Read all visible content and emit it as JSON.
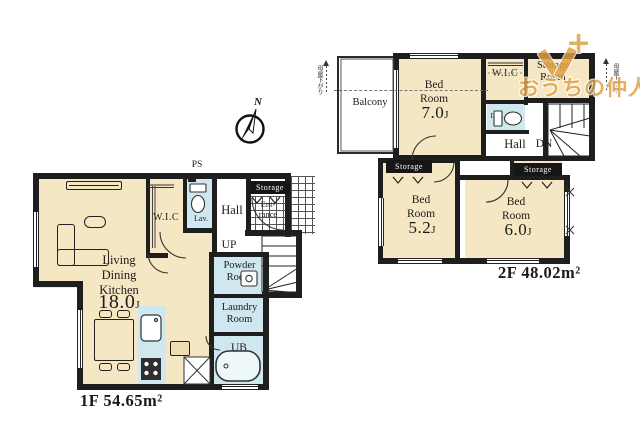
{
  "watermark": {
    "plus": "+",
    "brand": "おうちの仲人",
    "color": "#dfa044"
  },
  "annotations": {
    "compass": "N",
    "slope_note_left": "母屋下がり",
    "slope_note_right": "母屋下がり"
  },
  "colors": {
    "wall": "#1e1e1e",
    "floor_cream": "#f5e6c4",
    "wet_blue": "#cfe7ef",
    "white": "#ffffff",
    "watermark_orange": "#dfa044"
  },
  "floors": {
    "f1": {
      "area_label": "1F 54.65m²",
      "rooms": {
        "ldk": {
          "lines": [
            "Living",
            "Dining",
            "Kitchen"
          ],
          "size": "18.0",
          "size_unit": "J"
        },
        "wic": "W.I.C",
        "lav": "Lav.",
        "hall": "Hall",
        "storage": "Storage",
        "entrance": {
          "lines": [
            "Ent-",
            "rance"
          ]
        },
        "up": "UP",
        "ps": "PS",
        "powder": {
          "lines": [
            "Powder",
            "Room"
          ]
        },
        "laundry": {
          "lines": [
            "Laundry",
            "Room"
          ]
        },
        "ub": "UB"
      }
    },
    "f2": {
      "area_label": "2F 48.02m²",
      "rooms": {
        "balcony": "Balcony",
        "bed7": {
          "lines": [
            "Bed",
            "Room"
          ],
          "size": "7.0",
          "size_unit": "J"
        },
        "bed5": {
          "lines": [
            "Bed",
            "Room"
          ],
          "size": "5.2",
          "size_unit": "J"
        },
        "bed6": {
          "lines": [
            "Bed",
            "Room"
          ],
          "size": "6.0",
          "size_unit": "J"
        },
        "wic": "W.I.C",
        "storage_room": {
          "lines": [
            "Storage",
            "Room"
          ]
        },
        "lav": "Lav.",
        "hall": "Hall",
        "dn": "DN",
        "storage_left": "Storage",
        "storage_right": "Storage"
      }
    }
  }
}
